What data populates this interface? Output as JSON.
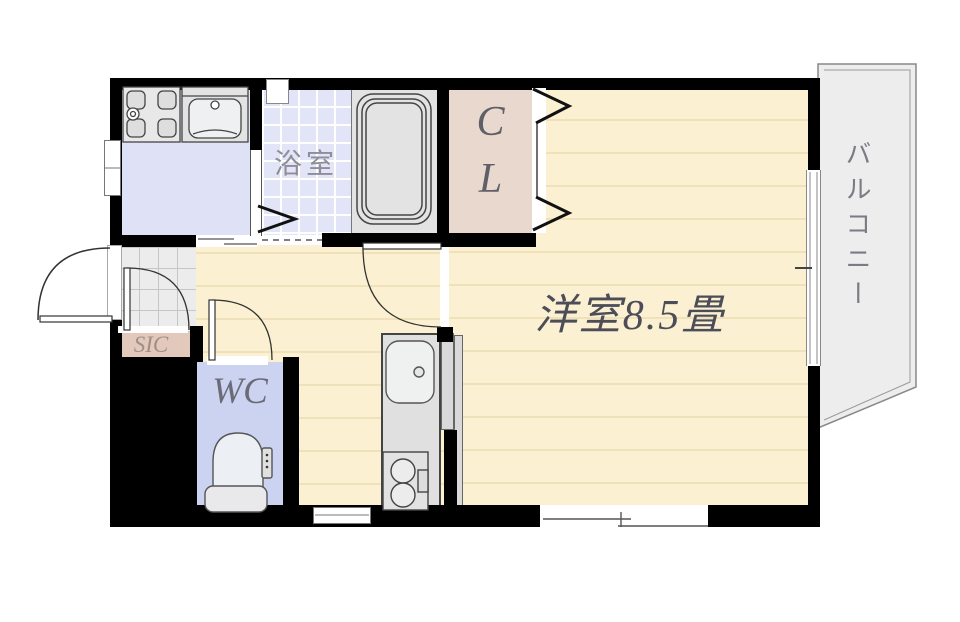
{
  "title": "apartment-floor-plan",
  "rooms": {
    "bathroom": {
      "label": "浴室"
    },
    "closet": {
      "label": "C\nL"
    },
    "main_room": {
      "label": "洋室8.5畳"
    },
    "balcony": {
      "label": "バルコニー"
    },
    "shoe_closet": {
      "label": "SIC"
    },
    "toilet_room": {
      "label": "WC"
    }
  },
  "icons": {
    "bathtub-icon": "nested rounded rectangles",
    "washer-pan-icon": "square pan with four corner pads and drain circle",
    "washbasin-icon": "vanity bowl with faucet dot",
    "toilet-icon": "toilet bowl with tank and control panel",
    "kitchen-sink-icon": "rounded sink with faucet dot",
    "stove-icon": "two-burner stove with grill",
    "door-arc-icon": "quarter-circle swing door",
    "folding-door-icon": "zigzag bifold door",
    "sliding-window-icon": "offset double lines",
    "dashed-threshold-icon": "dashed line opening"
  },
  "colors": {
    "wall": "#000000",
    "wood_floor": "#fbf1d2",
    "wood_line": "#efe2bb",
    "bathroom_tile": "#e2e5f7",
    "laundry": "#dfe1f7",
    "wc": "#ccd3f0",
    "closet": "#e8d8cd",
    "shoe_closet": "#e2c9bc",
    "genkan_tile": "#ececec",
    "balcony": "#ededed",
    "fixture": "#e3e3e3",
    "label_text": "#5f5f68"
  }
}
